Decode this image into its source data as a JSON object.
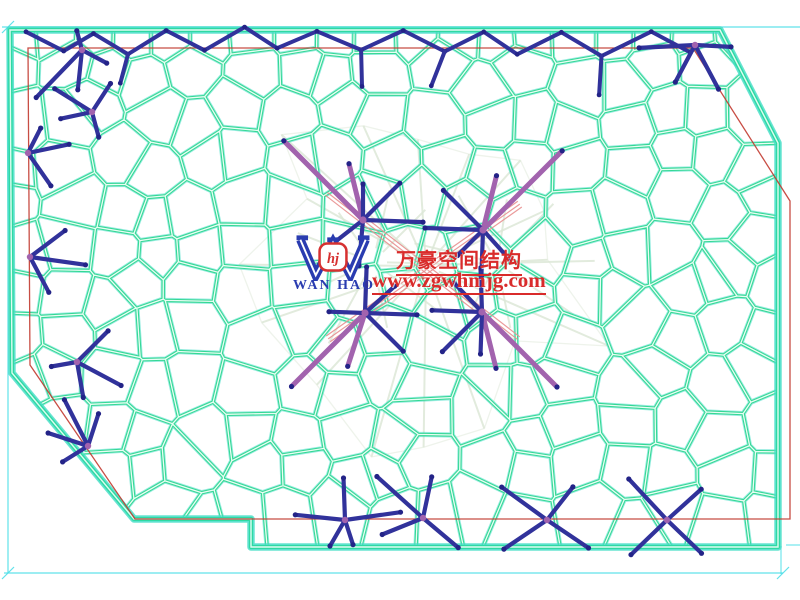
{
  "watermark": {
    "company_en": "WAN HAO",
    "monogram": "hj",
    "company_cn": "万豪空间结构",
    "website": "www.zgwhmjg.com"
  },
  "colors": {
    "background": "#ffffff",
    "mesh": "#35d894",
    "mesh_halo": "#43ddc6",
    "mesh_core": "#f2fff9",
    "boundary": "#2fd9a2",
    "frame": "#4fdfe8",
    "outline_red": "#c23a30",
    "guide": "#dde8d8",
    "cable": "#e89090",
    "tree_blue": "#31329b",
    "tree_dot": "#232387",
    "node_purple": "#a263ae",
    "watermark_red": "#d92b2b",
    "watermark_blue": "#2a3cb0"
  },
  "canvas": {
    "width": 800,
    "height": 600
  },
  "frame": {
    "left": 8,
    "top": 27,
    "right": 783,
    "bottom": 573,
    "top_overshoot": 800,
    "drop_line_x": 781,
    "drop_line_y1": 546,
    "drop_line_y2": 574,
    "dash_y": 545,
    "dash_x1": 786,
    "dash_x2": 800
  },
  "roof_outline": [
    [
      10,
      30
    ],
    [
      720,
      30
    ],
    [
      778,
      143
    ],
    [
      778,
      547
    ],
    [
      251,
      547
    ],
    [
      251,
      519
    ],
    [
      134,
      519
    ],
    [
      12,
      373
    ]
  ],
  "building_outline": [
    [
      28,
      48
    ],
    [
      693,
      48
    ],
    [
      790,
      201
    ],
    [
      790,
      519
    ],
    [
      135,
      519
    ],
    [
      30,
      365
    ]
  ],
  "mesh": {
    "seed": 12,
    "spacing": 47,
    "row_step": 44,
    "top_row_y": 33,
    "neighbor_radius": 160,
    "edge_margin": 15
  },
  "fans": [
    {
      "cx": 426,
      "cy": 266,
      "count": 16,
      "r0": 115,
      "r1": 205,
      "ring": true
    },
    {
      "cx": 373,
      "cy": 262,
      "count": 9,
      "r0": 55,
      "r1": 105,
      "ring": false
    },
    {
      "cx": 497,
      "cy": 263,
      "count": 9,
      "r0": 55,
      "r1": 105,
      "ring": false
    }
  ],
  "cables": {
    "pairs": [
      [
        363,
        220,
        482,
        312
      ],
      [
        483,
        230,
        365,
        313
      ]
    ],
    "extension": 45,
    "offsets": [
      -3.5,
      0,
      3.5
    ]
  },
  "top_chain": {
    "x0": 26,
    "x1": 712,
    "y_hi": 30,
    "y_lo": 52,
    "step": 36
  },
  "center_nodes": [
    {
      "x": 363,
      "y": 220,
      "purple": [
        [
          225,
          112
        ],
        [
          256,
          58
        ]
      ],
      "blue": [
        [
          315,
          52
        ],
        [
          2,
          60
        ],
        [
          95,
          46
        ],
        [
          142,
          40
        ],
        [
          270,
          36
        ]
      ]
    },
    {
      "x": 483,
      "y": 230,
      "purple": [
        [
          315,
          112
        ],
        [
          284,
          56
        ]
      ],
      "blue": [
        [
          225,
          56
        ],
        [
          182,
          58
        ],
        [
          92,
          46
        ],
        [
          48,
          40
        ],
        [
          135,
          36
        ]
      ]
    },
    {
      "x": 365,
      "y": 313,
      "purple": [
        [
          135,
          104
        ],
        [
          108,
          56
        ]
      ],
      "blue": [
        [
          45,
          54
        ],
        [
          2,
          52
        ],
        [
          272,
          46
        ],
        [
          318,
          40
        ],
        [
          182,
          36
        ]
      ]
    },
    {
      "x": 482,
      "y": 312,
      "purple": [
        [
          45,
          106
        ],
        [
          76,
          58
        ]
      ],
      "blue": [
        [
          135,
          56
        ],
        [
          182,
          50
        ],
        [
          268,
          44
        ],
        [
          226,
          40
        ],
        [
          92,
          42
        ]
      ]
    }
  ],
  "edge_trees": [
    {
      "x": 82,
      "y": 50,
      "arms": [
        [
          134,
          66
        ],
        [
          96,
          40
        ],
        [
          255,
          20
        ],
        [
          28,
          28
        ]
      ]
    },
    {
      "x": 92,
      "y": 112,
      "arms": [
        [
          212,
          44
        ],
        [
          168,
          32
        ],
        [
          303,
          34
        ],
        [
          75,
          26
        ]
      ]
    },
    {
      "x": 28,
      "y": 153,
      "arms": [
        [
          348,
          42
        ],
        [
          55,
          40
        ],
        [
          297,
          28
        ]
      ]
    },
    {
      "x": 30,
      "y": 257,
      "arms": [
        [
          8,
          56
        ],
        [
          323,
          44
        ],
        [
          62,
          40
        ]
      ]
    },
    {
      "x": 77,
      "y": 362,
      "arms": [
        [
          28,
          50
        ],
        [
          315,
          44
        ],
        [
          80,
          36
        ],
        [
          170,
          26
        ]
      ]
    },
    {
      "x": 88,
      "y": 446,
      "arms": [
        [
          243,
          52
        ],
        [
          198,
          42
        ],
        [
          288,
          34
        ],
        [
          148,
          30
        ]
      ]
    },
    {
      "x": 695,
      "y": 45,
      "arms": [
        [
          177,
          56
        ],
        [
          3,
          36
        ],
        [
          62,
          50
        ],
        [
          118,
          42
        ]
      ]
    },
    {
      "x": 345,
      "y": 520,
      "arms": [
        [
          268,
          42
        ],
        [
          352,
          56
        ],
        [
          186,
          50
        ],
        [
          120,
          30
        ],
        [
          72,
          26
        ]
      ]
    },
    {
      "x": 423,
      "y": 518,
      "arms": [
        [
          222,
          62
        ],
        [
          40,
          46
        ],
        [
          282,
          42
        ],
        [
          158,
          44
        ]
      ]
    },
    {
      "x": 547,
      "y": 520,
      "arms": [
        [
          216,
          56
        ],
        [
          34,
          50
        ],
        [
          146,
          52
        ],
        [
          308,
          42
        ]
      ]
    },
    {
      "x": 667,
      "y": 520,
      "arms": [
        [
          227,
          56
        ],
        [
          44,
          48
        ],
        [
          136,
          50
        ],
        [
          318,
          46
        ]
      ]
    }
  ]
}
